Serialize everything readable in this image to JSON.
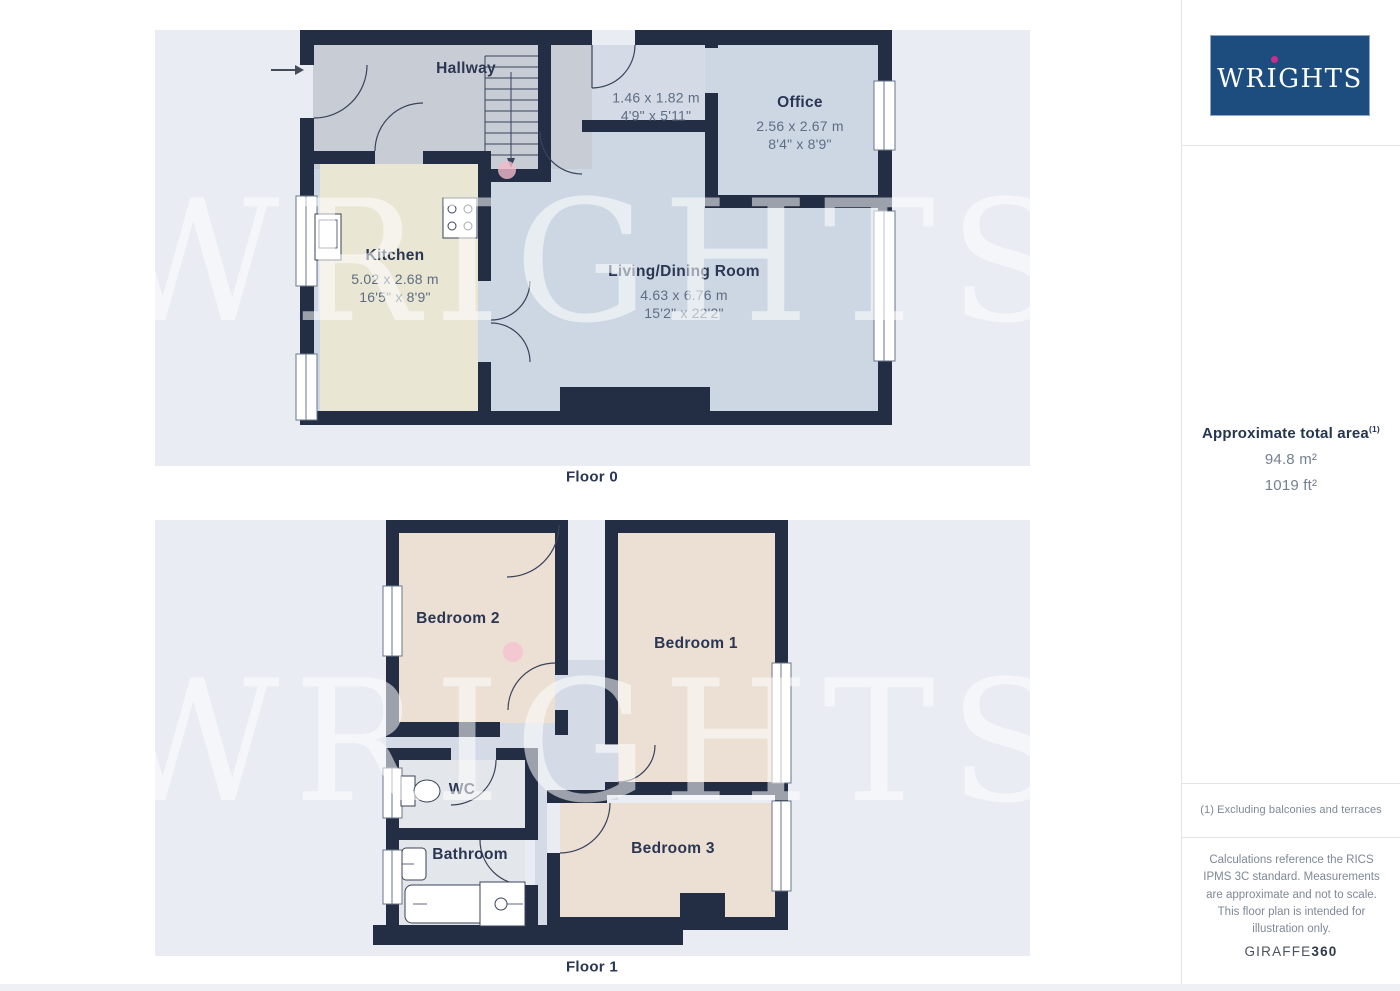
{
  "watermark": {
    "text": "WRIGHTS"
  },
  "sidebar": {
    "logo": {
      "text": "WRIGHTS"
    },
    "area": {
      "title": "Approximate total area",
      "marker": "(1)",
      "metric": "94.8 m²",
      "imperial": "1019 ft²"
    },
    "footnote": "(1) Excluding balconies and terraces",
    "disclaimer": "Calculations reference the RICS IPMS 3C standard. Measurements are approximate and not to scale. This floor plan is intended for illustration only.",
    "brand": {
      "name": "GIRAFFE",
      "suffix": "360"
    }
  },
  "floors": [
    {
      "label": "Floor 0",
      "rooms": [
        {
          "name": "Hallway",
          "dims_m": "",
          "dims_ft": ""
        },
        {
          "name": "",
          "dims_m": "1.46 x 1.82 m",
          "dims_ft": "4'9\" x 5'11\""
        },
        {
          "name": "Office",
          "dims_m": "2.56 x 2.67 m",
          "dims_ft": "8'4\" x 8'9\""
        },
        {
          "name": "Kitchen",
          "dims_m": "5.02 x 2.68 m",
          "dims_ft": "16'5\" x 8'9\""
        },
        {
          "name": "Living/Dining Room",
          "dims_m": "4.63 x 6.76 m",
          "dims_ft": "15'2\" x 22'2\""
        }
      ]
    },
    {
      "label": "Floor 1",
      "rooms": [
        {
          "name": "Bedroom 2"
        },
        {
          "name": "Bedroom 1"
        },
        {
          "name": "WC"
        },
        {
          "name": "Bathroom"
        },
        {
          "name": "Bedroom 3"
        }
      ]
    }
  ],
  "colors": {
    "wall": "#232e45",
    "plan_bg": "#e9edf3",
    "hallway": "#c8cdd5",
    "landing": "#d4dbe6",
    "room_blue": "#cdd7e4",
    "kitchen": "#e9e6d3",
    "bedroom": "#ecdfd3",
    "bathroom": "#e3e6ea",
    "logo_bg": "#1d4d7f",
    "logo_dot": "#c92d8c",
    "camera_dot": "#f3bcca"
  }
}
